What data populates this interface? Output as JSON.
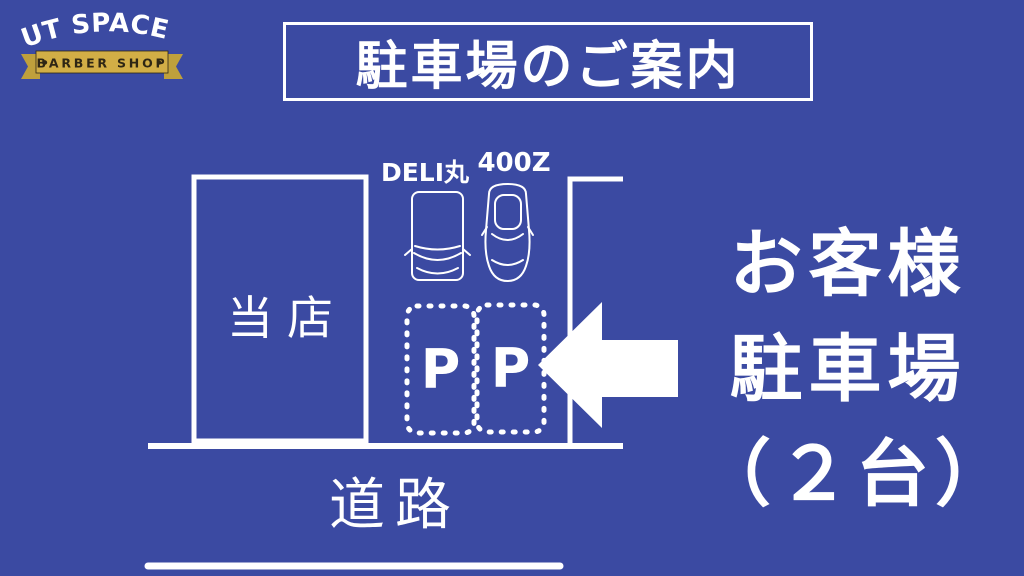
{
  "logo": {
    "title": "CUT SPACE K",
    "subtitle": "BARBER SHOP"
  },
  "header": {
    "title": "駐車場のご案内"
  },
  "diagram": {
    "shop_label": "当店",
    "van_label": "DELI丸",
    "car_label": "400Z",
    "spot_labels": [
      "P",
      "P"
    ],
    "road_label": "道路"
  },
  "callout": {
    "lines": [
      "お客様",
      "駐車場",
      "（２台）"
    ]
  },
  "colors": {
    "background": "#3b4aa2",
    "foreground": "#ffffff",
    "gold": "#d2ae46",
    "gold_dark": "#bfa03c",
    "ribbon_text": "#2e2614"
  }
}
